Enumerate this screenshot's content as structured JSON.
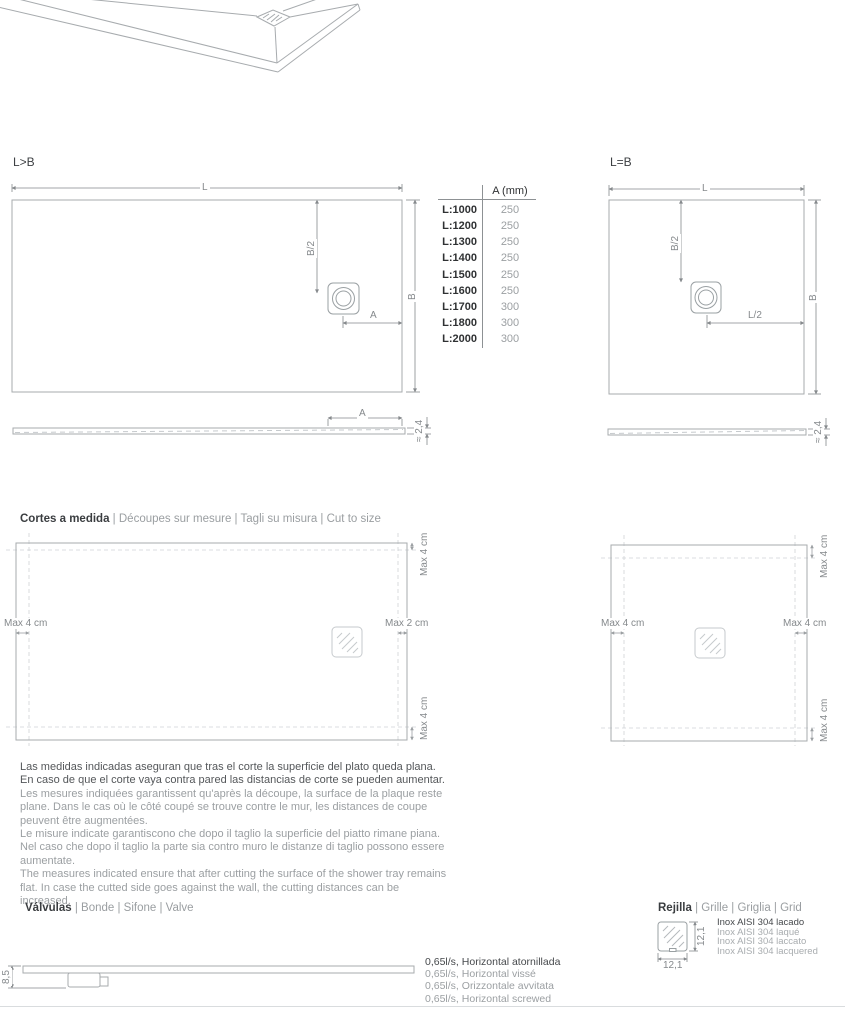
{
  "variants": {
    "rect_label": "L>B",
    "square_label": "L=B"
  },
  "dimensions": {
    "length": "L",
    "width": "B",
    "half_width": "B/2",
    "half_length": "L/2",
    "drain_offset": "A",
    "thickness": "≈ 2,4",
    "valve_height": "8,5",
    "grid_width": "12,1",
    "grid_height": "12,1"
  },
  "drain_table": {
    "header": "A (mm)",
    "rows": [
      {
        "length": "L:1000",
        "a": "250"
      },
      {
        "length": "L:1200",
        "a": "250"
      },
      {
        "length": "L:1300",
        "a": "250"
      },
      {
        "length": "L:1400",
        "a": "250"
      },
      {
        "length": "L:1500",
        "a": "250"
      },
      {
        "length": "L:1600",
        "a": "250"
      },
      {
        "length": "L:1700",
        "a": "300"
      },
      {
        "length": "L:1800",
        "a": "300"
      },
      {
        "length": "L:2000",
        "a": "300"
      }
    ]
  },
  "cut_to_size": {
    "heading_primary": "Cortes a medida",
    "heading_secondary": " | Découpes sur mesure | Tagli su misura | Cut to size",
    "rect_diagram": {
      "top": "Max 4 cm",
      "left": "Max 4 cm",
      "right": "Max 2 cm",
      "bottom": "Max 4 cm"
    },
    "square_diagram": {
      "top": "Max 4 cm",
      "left": "Max 4 cm",
      "right": "Max 4 cm",
      "bottom": "Max 4 cm"
    },
    "notes": {
      "es": "Las medidas indicadas aseguran que tras el corte la superficie del plato queda plana. En caso de que el corte vaya contra pared las distancias de corte se pueden aumentar.",
      "fr": "Les mesures indiquées garantissent qu'après la découpe, la surface de la plaque reste plane. Dans le cas où le côté coupé se trouve contre le mur, les distances de coupe peuvent être augmentées.",
      "it": "Le misure indicate garantiscono che dopo il taglio la superficie del piatto rimane piana. Nel caso che dopo il taglio la parte sia contro muro le distanze di taglio possono essere aumentate.",
      "en": "The measures indicated ensure that after cutting the surface of the shower tray remains flat. In case the cutted side goes against the wall, the cutting distances can be increased."
    }
  },
  "valves": {
    "heading_primary": "Válvulas",
    "heading_secondary": " | Bonde | Sifone | Valve",
    "specs": [
      {
        "text": "0,65l/s, Horizontal atornillada"
      },
      {
        "text": "0,65l/s, Horizontal vissé"
      },
      {
        "text": "0,65l/s, Orizzontale avvitata"
      },
      {
        "text": "0,65l/s, Horizontal screwed"
      }
    ]
  },
  "grid": {
    "heading_primary": "Rejilla",
    "heading_secondary": " | Grille | Griglia | Grid",
    "materials": [
      {
        "text": "Inox AISI 304 lacado"
      },
      {
        "text": "Inox AISI 304 laqué"
      },
      {
        "text": "Inox AISI 304 laccato"
      },
      {
        "text": "Inox AISI 304 lacquered"
      }
    ]
  },
  "colors": {
    "line": "#a7abae",
    "dash": "#cfd3d6",
    "text_dark": "#3d4043",
    "text_gray": "#9b9fa2"
  }
}
